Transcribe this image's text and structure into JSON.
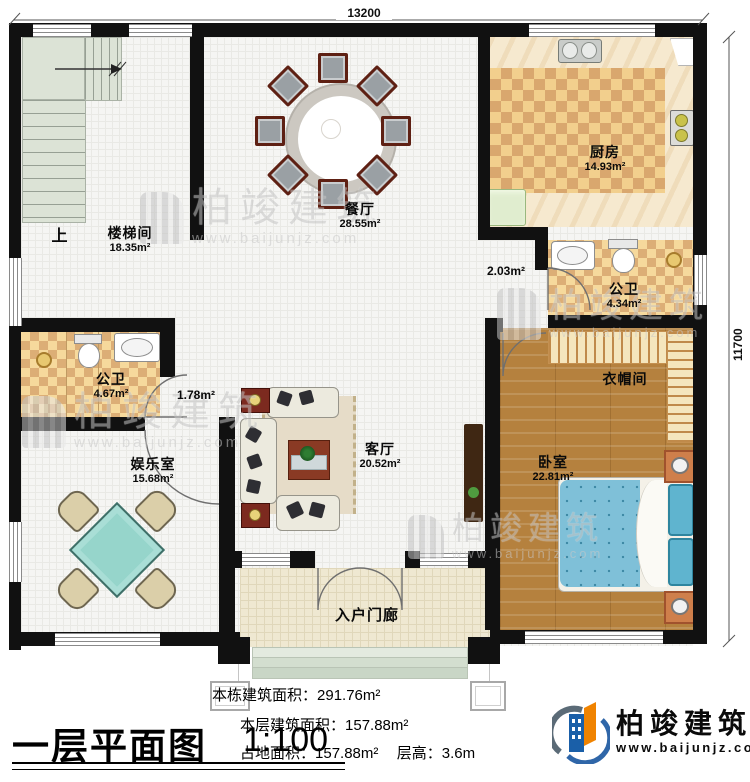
{
  "dimensions": {
    "top": "13200",
    "right": "11700"
  },
  "rooms": {
    "stair": {
      "name": "楼梯间",
      "area": "18.35m²"
    },
    "dining": {
      "name": "餐厅",
      "area": "28.55m²"
    },
    "kitchen": {
      "name": "厨房",
      "area": "14.93m²"
    },
    "bath_top": {
      "name": "公卫",
      "area": "4.34m²"
    },
    "cloakroom": {
      "name": "衣帽间"
    },
    "bedroom": {
      "name": "卧室",
      "area": "22.81m²"
    },
    "bath_left": {
      "name": "公卫",
      "area": "4.67m²"
    },
    "entertainment": {
      "name": "娱乐室",
      "area": "15.68m²"
    },
    "living": {
      "name": "客厅",
      "area": "20.52m²"
    },
    "porch": {
      "name": "入户门廊"
    }
  },
  "annotations": {
    "up": "上",
    "hall_area_right": "2.03m²",
    "hall_area_left": "1.78m²"
  },
  "title": {
    "text": "一层平面图",
    "scale": "1:100"
  },
  "stats": {
    "building_total_label": "本栋建筑面积：",
    "building_total_value": "291.76m²",
    "floor_area_label": "本层建筑面积：",
    "floor_area_value": "157.88m²",
    "footprint_label": "占地面积：",
    "footprint_value": "157.88m²",
    "floor_height_label": "层高：",
    "floor_height_value": "3.6m"
  },
  "brand": {
    "name": "柏竣建筑",
    "site": "www.baijunjz.com"
  },
  "watermark": {
    "name": "柏竣建筑",
    "site": "www.baijunjz.com"
  }
}
